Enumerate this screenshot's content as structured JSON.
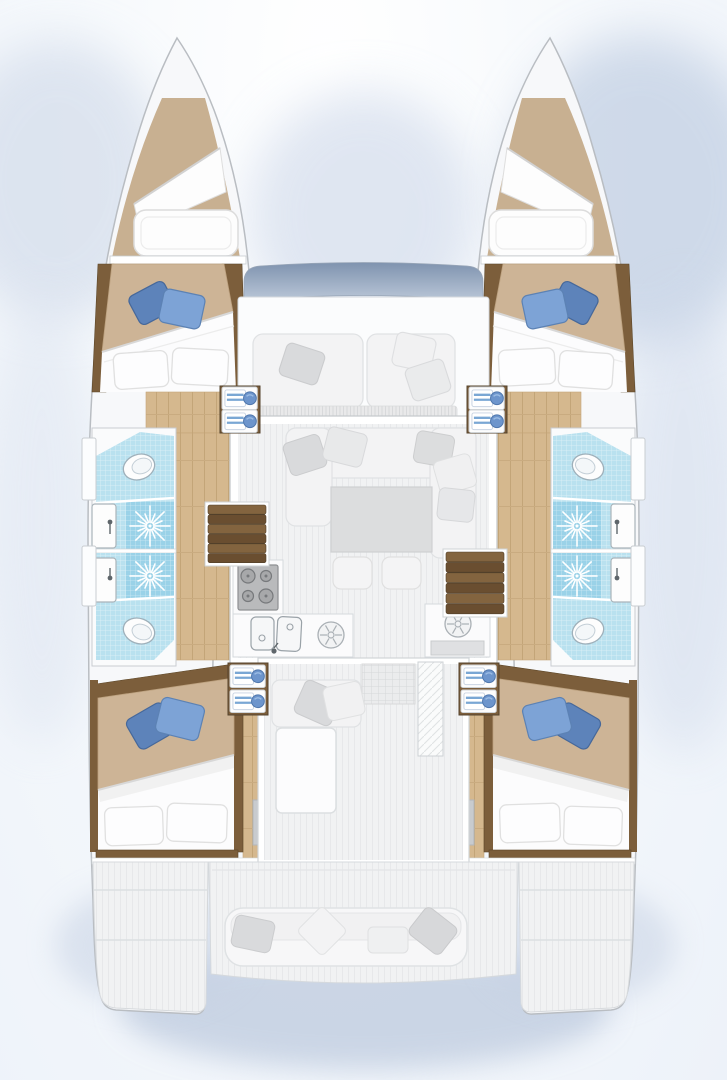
{
  "page": {
    "title": "Catamaran yacht interior layout plan — overhead view",
    "type": "floorplan-diagram",
    "text_on_screen": "none"
  },
  "colors": {
    "hull": "#f7f8fa",
    "hullStroke": "#b9bdc2",
    "woodDark": "#7c5e3b",
    "woodDarkEdge": "#5d4729",
    "plank": "#d5b88e",
    "plankLine": "#c3a578",
    "forepeak": "#c8b091",
    "bedTan": "#cdb496",
    "duvet": "#fcfcfd",
    "pillowWhite": "#fdfdfe",
    "pillowStroke": "#e0e0e0",
    "pillowBlueDark": "#5d83ba",
    "pillowBlueLight": "#7da3d6",
    "tile": "#b9e1ef",
    "tileDeep": "#9ad2e8",
    "towelBlue": "#6d95cc",
    "salonFloor": "#f1f2f3",
    "furniture": "#f3f3f4",
    "furnitureStroke": "#e0e2e4",
    "pillowGray": "#d9dadc",
    "tableGray": "#dcddde",
    "stoveGray": "#b9babc",
    "steelStroke": "#9aa2a8",
    "windowBandTop": "#7f93af",
    "windowBandBottom": "#b9c6d7",
    "wallStroke": "#c9cdd1",
    "glowBlue": "#bfcde2",
    "sternShadow": "#b6c4da"
  },
  "vessel": {
    "kind": "sailing catamaran deck plan",
    "symmetry": "port and starboard hulls mirrored",
    "hull_rooms": [
      {
        "label": "forepeak locker",
        "contents": [
          "sail bag cushion",
          "berth pad"
        ]
      },
      {
        "label": "forward cabin",
        "contents": [
          "double berth",
          "2 white pillows",
          "2 blue accent pillows",
          "towel shelf"
        ]
      },
      {
        "label": "forward head",
        "contents": [
          "toilet",
          "washbasin",
          "shower with jet symbol",
          "blue tiled floor"
        ]
      },
      {
        "label": "aft head",
        "contents": [
          "toilet",
          "washbasin",
          "shower with jet symbol",
          "blue tiled floor"
        ]
      },
      {
        "label": "aft cabin",
        "contents": [
          "double berth",
          "2 white pillows",
          "2 blue accent pillows",
          "towel shelf"
        ]
      },
      {
        "label": "swim platform"
      }
    ],
    "bridgedeck": {
      "front_window_band": true,
      "foredeck_seating": {
        "cushions": 2,
        "pillows": 3
      },
      "salon": {
        "sofa": "U-shaped",
        "pillows": 5,
        "table": 1,
        "stools": 2
      },
      "galley": {
        "stove_burners": 4,
        "double_sink": true,
        "round_elements": 2
      },
      "companionway_steps": 2,
      "cockpit": {
        "bench": 1,
        "bench_pillows": 2,
        "table": 1,
        "louvered_door": true,
        "grid_mat": true
      },
      "aft_deck": {
        "transom_bench": 1,
        "transom_pillows": 4
      }
    },
    "counts": {
      "cabins": 4,
      "heads": 4,
      "berths": 4
    }
  }
}
